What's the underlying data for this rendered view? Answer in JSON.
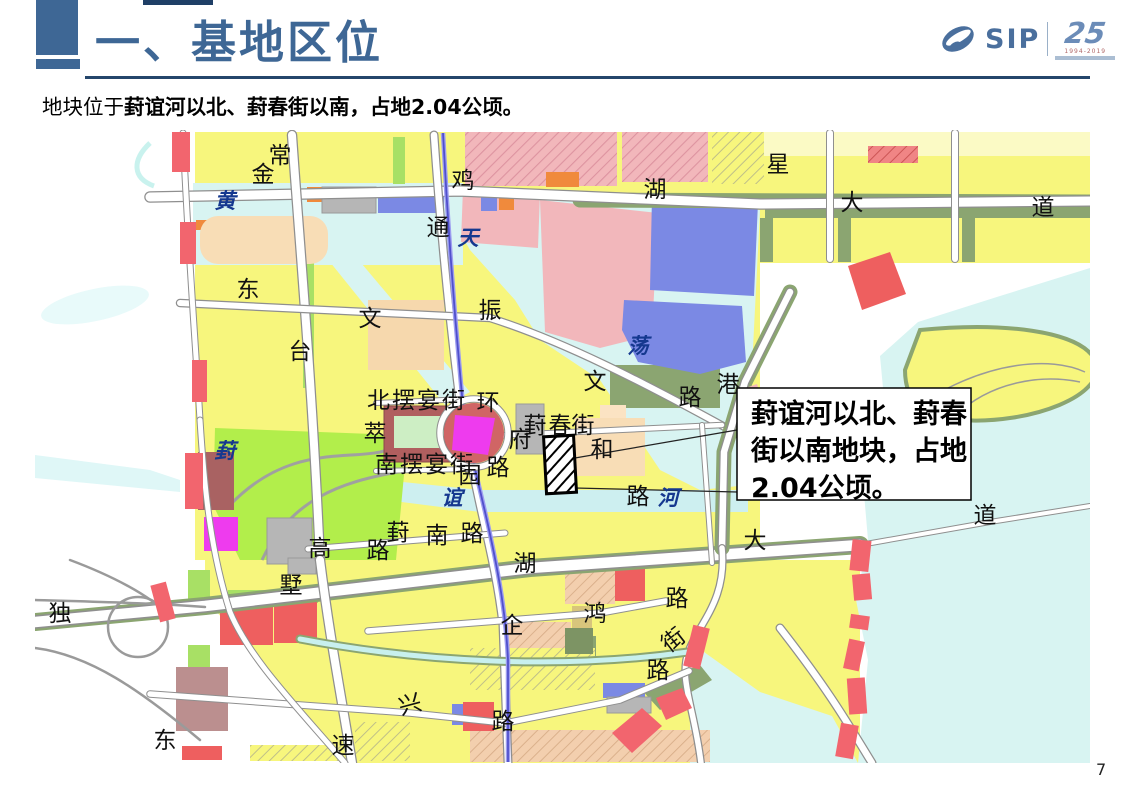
{
  "header": {
    "title": "一、基地区位"
  },
  "logo": {
    "company": "SIP",
    "anniversary": "25",
    "years": "1994-2019"
  },
  "intro": {
    "prefix": "地块位于",
    "highlight": "葑谊河以北、葑春街以南，占地2.04公顷。"
  },
  "map": {
    "callout": {
      "lines": [
        "葑谊河以北、葑春",
        "街以南地块，占地",
        "2.04公顷。"
      ]
    },
    "labels": [
      {
        "t": "常",
        "x": 280,
        "y": 163
      },
      {
        "t": "金",
        "x": 263,
        "y": 182
      },
      {
        "t": "鸡",
        "x": 463,
        "y": 188
      },
      {
        "t": "湖",
        "x": 655,
        "y": 197
      },
      {
        "t": "星",
        "x": 778,
        "y": 172
      },
      {
        "t": "大",
        "x": 852,
        "y": 210
      },
      {
        "t": "道",
        "x": 1043,
        "y": 215
      },
      {
        "t": "黄",
        "x": 225,
        "y": 208,
        "w": 1
      },
      {
        "t": "通",
        "x": 438,
        "y": 235
      },
      {
        "t": "天",
        "x": 468,
        "y": 245,
        "w": 1
      },
      {
        "t": "东",
        "x": 248,
        "y": 297
      },
      {
        "t": "振",
        "x": 490,
        "y": 318
      },
      {
        "t": "文",
        "x": 370,
        "y": 326
      },
      {
        "t": "台",
        "x": 300,
        "y": 359
      },
      {
        "t": "荡",
        "x": 638,
        "y": 353,
        "w": 1
      },
      {
        "t": "文",
        "x": 595,
        "y": 389
      },
      {
        "t": "路",
        "x": 690,
        "y": 405
      },
      {
        "t": "港",
        "x": 728,
        "y": 392
      },
      {
        "t": "北摆宴街",
        "x": 417,
        "y": 408,
        "s": 20,
        "ls": 2
      },
      {
        "t": "环",
        "x": 488,
        "y": 410
      },
      {
        "t": "萃",
        "x": 375,
        "y": 441
      },
      {
        "t": "府",
        "x": 520,
        "y": 447
      },
      {
        "t": "葑",
        "x": 535,
        "y": 433
      },
      {
        "t": "春",
        "x": 560,
        "y": 433
      },
      {
        "t": "街",
        "x": 583,
        "y": 433
      },
      {
        "t": "和",
        "x": 602,
        "y": 457
      },
      {
        "t": "南摆宴街",
        "x": 425,
        "y": 472,
        "s": 20,
        "ls": 2
      },
      {
        "t": "园",
        "x": 470,
        "y": 483
      },
      {
        "t": "路",
        "x": 498,
        "y": 475
      },
      {
        "t": "谊",
        "x": 452,
        "y": 505,
        "w": 1
      },
      {
        "t": "路",
        "x": 638,
        "y": 504
      },
      {
        "t": "河",
        "x": 668,
        "y": 505,
        "w": 1
      },
      {
        "t": "葑",
        "x": 225,
        "y": 458,
        "w": 1
      },
      {
        "t": "高",
        "x": 320,
        "y": 556
      },
      {
        "t": "路",
        "x": 378,
        "y": 558
      },
      {
        "t": "墅",
        "x": 291,
        "y": 593
      },
      {
        "t": "葑",
        "x": 398,
        "y": 540
      },
      {
        "t": "南",
        "x": 437,
        "y": 543
      },
      {
        "t": "路",
        "x": 472,
        "y": 541
      },
      {
        "t": "湖",
        "x": 525,
        "y": 571
      },
      {
        "t": "大",
        "x": 755,
        "y": 548
      },
      {
        "t": "道",
        "x": 985,
        "y": 523
      },
      {
        "t": "独",
        "x": 60,
        "y": 621
      },
      {
        "t": "企",
        "x": 512,
        "y": 633
      },
      {
        "t": "鸿",
        "x": 595,
        "y": 621
      },
      {
        "t": "路",
        "x": 677,
        "y": 606
      },
      {
        "t": "街",
        "x": 678,
        "y": 646,
        "r": -38
      },
      {
        "t": "路",
        "x": 658,
        "y": 678
      },
      {
        "t": "兴",
        "x": 412,
        "y": 712,
        "r": -15
      },
      {
        "t": "路",
        "x": 503,
        "y": 729
      },
      {
        "t": "东",
        "x": 165,
        "y": 748
      },
      {
        "t": "速",
        "x": 343,
        "y": 753
      }
    ]
  },
  "page_number": "7"
}
